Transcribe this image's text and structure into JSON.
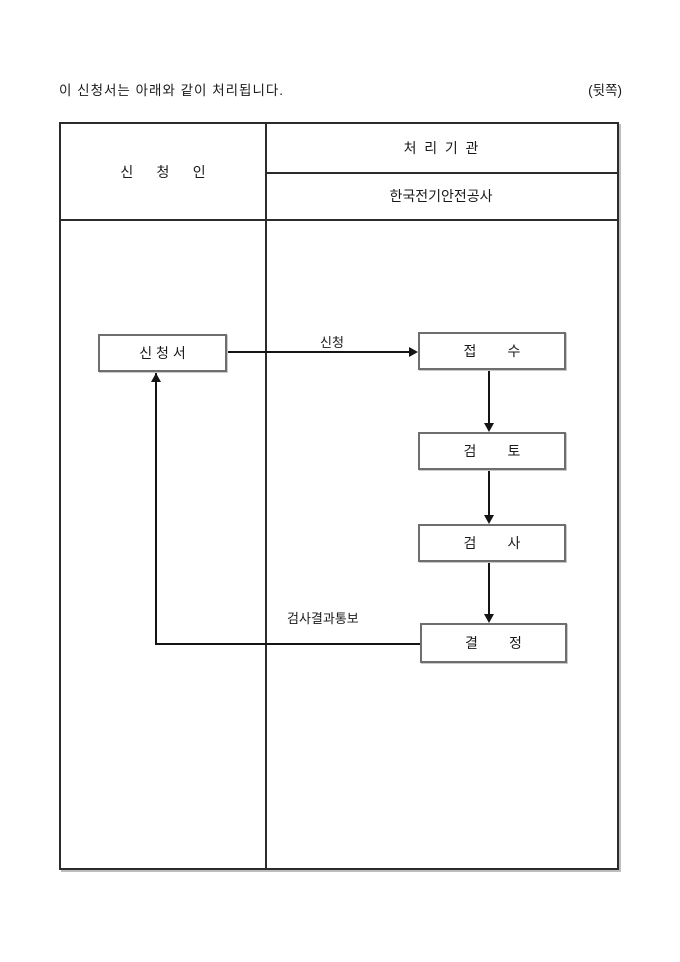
{
  "page": {
    "note": "이 신청서는 아래와 같이 처리됩니다.",
    "back_label": "(뒷쪽)"
  },
  "table": {
    "applicant_header": "신      청      인",
    "agency_header": "처  리  기  관",
    "agency_name": "한국전기안전공사"
  },
  "flow": {
    "boxes": {
      "application": "신 청 서",
      "receipt": "접        수",
      "review": "검        토",
      "inspection": "검        사",
      "decision": "결        정"
    },
    "edges": {
      "apply_label": "신청",
      "result_label": "검사결과통보"
    }
  },
  "colors": {
    "background": "#ffffff",
    "text": "#1a1a1a",
    "table_border": "#2b2b2b",
    "box_border": "#6e6e6e",
    "flow_line": "#141414"
  }
}
